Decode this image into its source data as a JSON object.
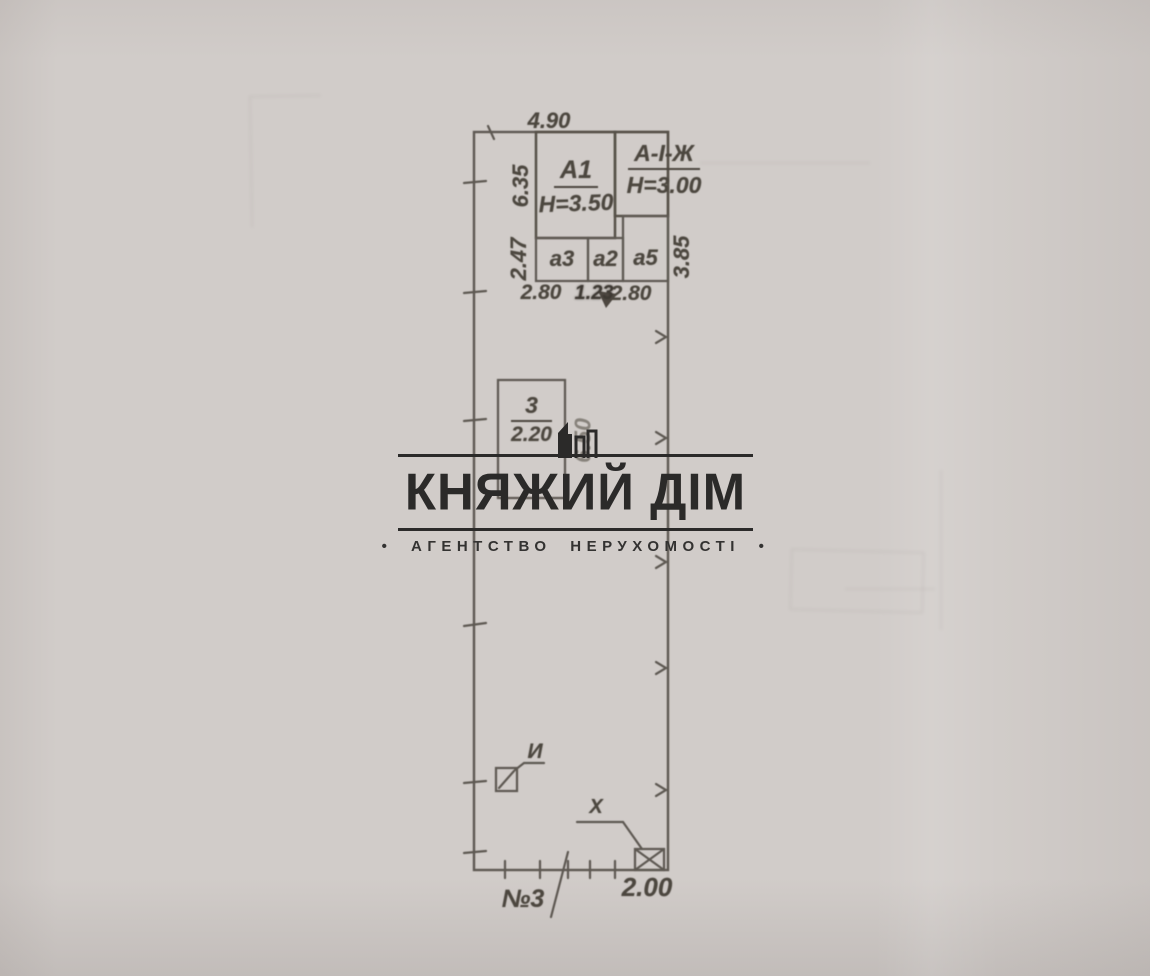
{
  "watermark": {
    "title": "КНЯЖИЙ ДІМ",
    "subtitle": "• АГЕНТСТВО НЕРУХОМОСТІ •",
    "ink_color": "#2b2a29"
  },
  "plan": {
    "ink_color": "#54504a",
    "buildings": {
      "a1_label": "А1",
      "a1_height": "Н=3.50",
      "aizh_label": "А-І-Ж",
      "aizh_height": "Н=3.00",
      "a3_label": "а3",
      "a2_label": "а2",
      "a5_label": "а5",
      "b3_label": "3",
      "b3_width": "2.20"
    },
    "dimensions": {
      "top_width": "4.90",
      "left_upper": "6.35",
      "left_lower": "2.47",
      "bottom_a3": "2.80",
      "bottom_a2": "1.23",
      "bottom_a5": "2.80",
      "right_a5": "3.85",
      "b3_side": "6.50",
      "bottom_gate": "2.00"
    },
    "markers": {
      "marker_i": "И",
      "marker_x": "Х",
      "plot_number": "№3"
    }
  }
}
